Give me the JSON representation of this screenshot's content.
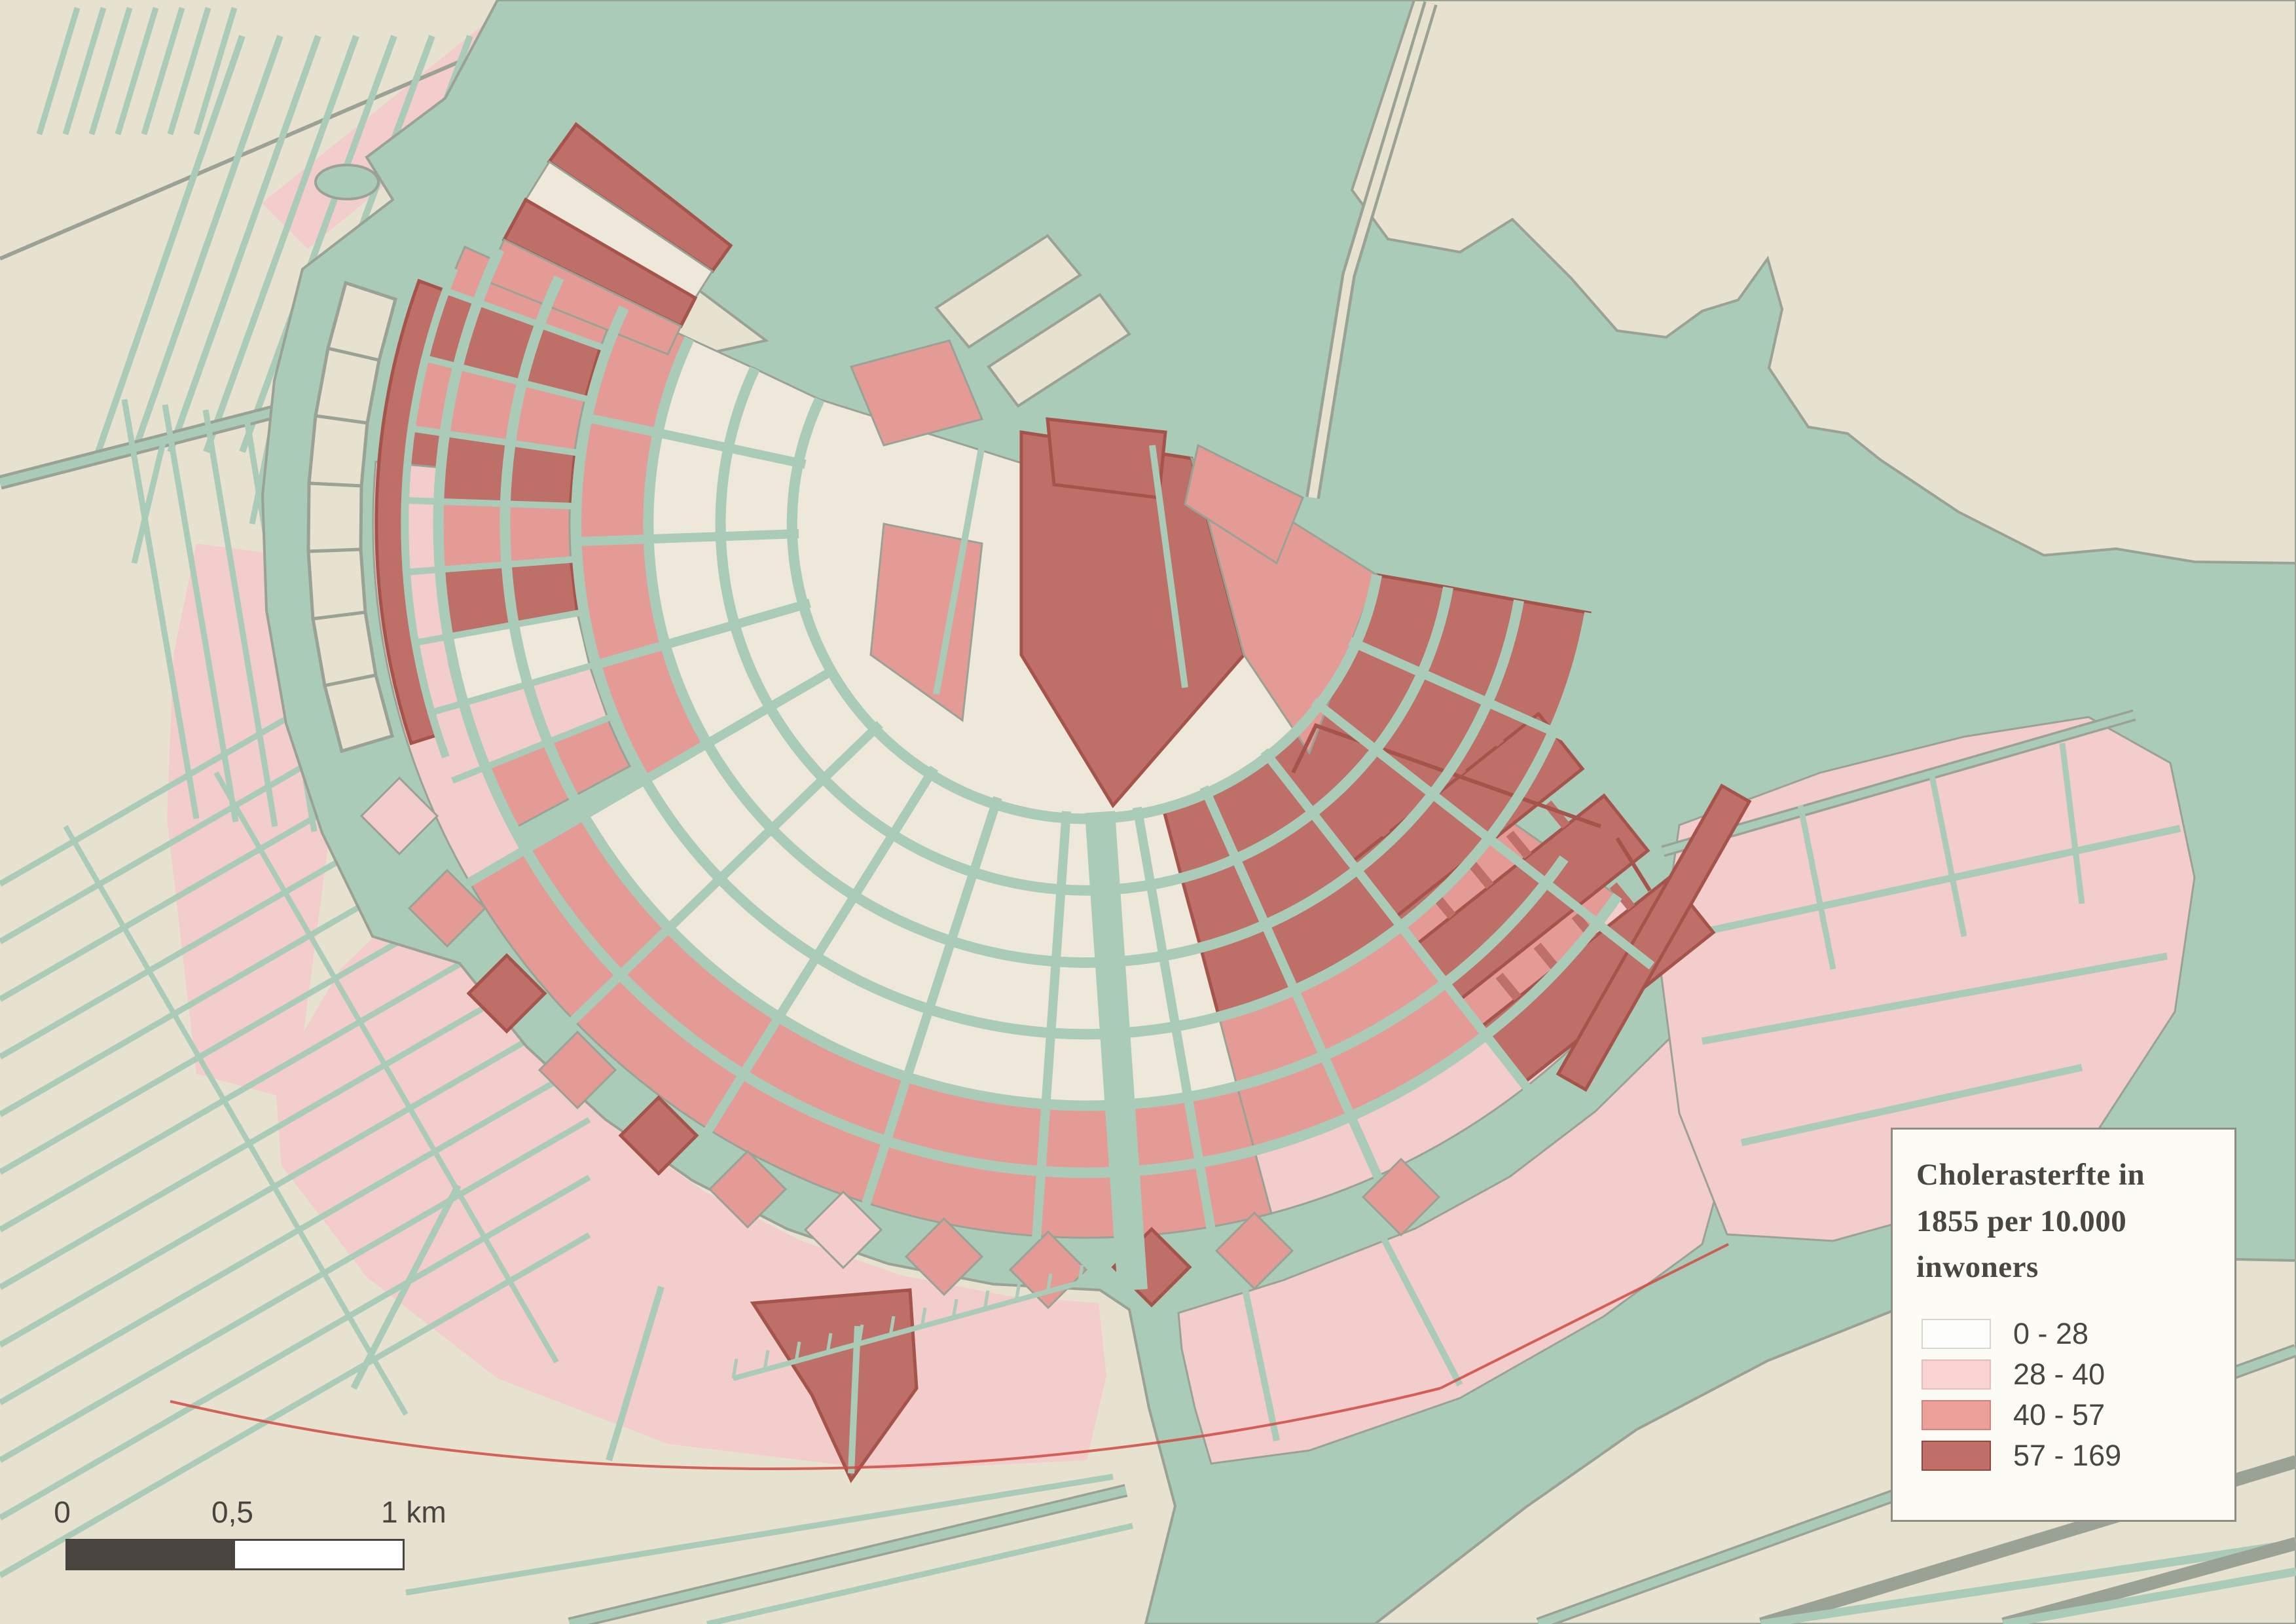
{
  "palette": {
    "water": "#A9CBB8",
    "land": "#E7E1D0",
    "cream": "#EDE8DA",
    "pink": "#F2CDCB",
    "salmon": "#E59B95",
    "darkred": "#BE6F67",
    "darkredline": "#A5544B",
    "casing": "#9AA295",
    "redline": "#D04A42",
    "text": "#4C4641",
    "legendbg": "#FCFBF5",
    "legendborder": "#8E8E84",
    "scaledark": "#4A4440"
  },
  "legend": {
    "title": "Cholerasterfte in 1855 per 10.000 inwoners",
    "classes": [
      {
        "label": "0 - 28",
        "color": "#FDFDFB"
      },
      {
        "label": "28 - 40",
        "color": "#F8D3D2"
      },
      {
        "label": "40 - 57",
        "color": "#EC9E99"
      },
      {
        "label": "57 - 169",
        "color": "#C06F68"
      }
    ]
  },
  "scale_bar": {
    "labels": [
      "0",
      "0,5",
      "1 km"
    ]
  }
}
